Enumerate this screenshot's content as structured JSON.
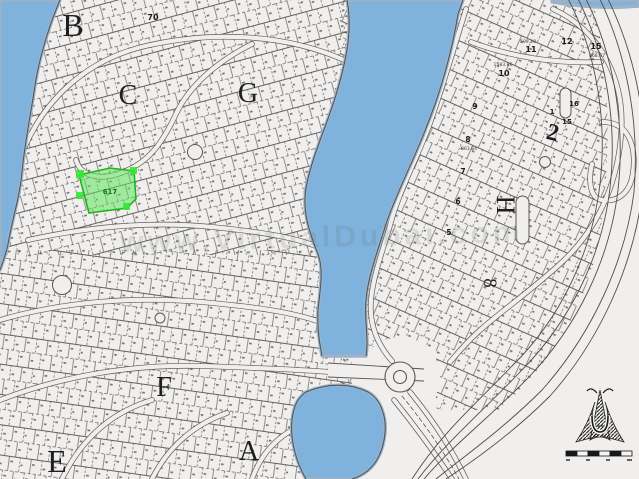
{
  "map": {
    "type": "cadastral-plot-map",
    "section_letters": [
      {
        "label": "B"
      },
      {
        "label": "C"
      },
      {
        "label": "G"
      },
      {
        "label": "F"
      },
      {
        "label": "E"
      },
      {
        "label": "A"
      },
      {
        "label": "H"
      }
    ],
    "big_numbers": [
      {
        "label": "2"
      },
      {
        "label": "8"
      }
    ],
    "plot_numbers": [
      {
        "label": "70"
      },
      {
        "label": "10"
      },
      {
        "label": "11"
      },
      {
        "label": "12"
      },
      {
        "label": "15"
      },
      {
        "label": "9"
      },
      {
        "label": "8"
      },
      {
        "label": "7"
      },
      {
        "label": "6"
      },
      {
        "label": "5"
      },
      {
        "label": "16"
      },
      {
        "label": "15"
      },
      {
        "label": "1"
      }
    ],
    "area_labels": [
      {
        "label": "1383.86"
      },
      {
        "label": "599.28"
      },
      {
        "label": "868.87"
      },
      {
        "label": "863.84"
      }
    ],
    "highlighted_plot": {
      "number": "617",
      "fill": "#5ce65c",
      "border": "#1cb51c"
    },
    "watermark": {
      "text": "www.VirtualDubai.com"
    },
    "colors": {
      "water": "#7fb3de",
      "land": "#f2f0ee",
      "parcel_lines": "#424242",
      "coast": "#46525e"
    }
  }
}
